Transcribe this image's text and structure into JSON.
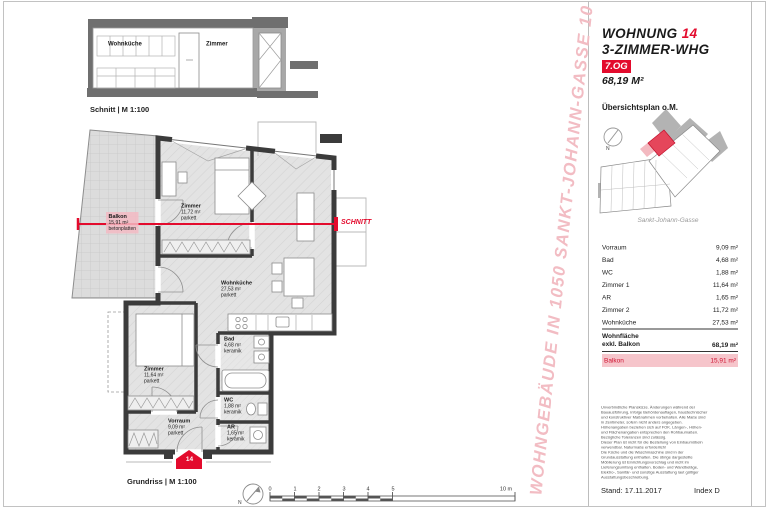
{
  "header": {
    "title": "WOHNUNG",
    "unit": "14",
    "type": "3-ZIMMER-WHG",
    "floor": "7.OG",
    "area": "68,19 M²"
  },
  "overview": {
    "title": "Übersichtsplan o.M.",
    "street": "Sankt-Johann-Gasse",
    "north": "N"
  },
  "section": {
    "caption": "Schnitt | M 1:100",
    "room1": "Wohnküche",
    "room2": "Zimmer"
  },
  "plan": {
    "caption": "Grundriss | M 1:100",
    "cut_label": "SCHNITT",
    "entrance": "14",
    "north": "N",
    "scale": {
      "t0": "0",
      "t1": "1",
      "t2": "2",
      "t3": "3",
      "t4": "4",
      "t5": "5",
      "end": "10 m"
    },
    "rooms": {
      "balkon": {
        "name": "Balkon",
        "area": "15,91 m²",
        "floor": "betonplatten"
      },
      "zimmer2": {
        "name": "Zimmer",
        "area": "11,72 m²",
        "floor": "parkett"
      },
      "wohnkueche": {
        "name": "Wohnküche",
        "area": "27,53 m²",
        "floor": "parkett"
      },
      "zimmer1": {
        "name": "Zimmer",
        "area": "11,64 m²",
        "floor": "parkett"
      },
      "bad": {
        "name": "Bad",
        "area": "4,68 m²",
        "floor": "keramik"
      },
      "wc": {
        "name": "WC",
        "area": "1,88 m²",
        "floor": "keramik"
      },
      "vorraum": {
        "name": "Vorraum",
        "area": "9,09 m²",
        "floor": "parkett"
      },
      "ar": {
        "name": "AR",
        "area": "1,65 m²",
        "floor": "keramik"
      }
    }
  },
  "table": {
    "rows": [
      {
        "label": "Vorraum",
        "value": "9,09 m²"
      },
      {
        "label": "Bad",
        "value": "4,68 m²"
      },
      {
        "label": "WC",
        "value": "1,88 m²"
      },
      {
        "label": "Zimmer 1",
        "value": "11,64 m²"
      },
      {
        "label": "AR",
        "value": "1,65 m²"
      },
      {
        "label": "Zimmer 2",
        "value": "11,72 m²"
      },
      {
        "label": "Wohnküche",
        "value": "27,53 m²"
      }
    ],
    "total_label_1": "Wohnfläche",
    "total_label_2": "exkl. Balkon",
    "total_value": "68,19 m²",
    "balkon_label": "Balkon",
    "balkon_value": "15,91 m²"
  },
  "watermark": "WOHNGEBÄUDE IN 1050 SANKT-JOHANN-GASSE 10",
  "footer": {
    "disclaimer": "Unverbindliche Planskizze. Änderungen während der\nBauausführung, infolge Behördenauflagen, haustechnischer\nund konstruktiver Maßnahmen vorbehalten. Alle Maße sind\nin Zentimeter, sofern nicht anders angegeben.\nHöhenangaben beziehen sich auf FOK. Längen-, Höhen-\nund Flächenangaben entsprechen den Rohbaumaßen.\nBezügliche Toleranzen sind zulässig.\nDieser Plan ist nicht für die Bestellung von Einbaumöbeln\nverwendbar. Naturmaße erforderlich!\nDie Küche und die Waschmaschine sind in der\nGrundausstattung enthalten. Die übrige dargestellte\nMöblierung ist Einrichtungsvorschlag und nicht im\nLieferungsumfang enthalten. Boden- und Wandbeläge,\nElektro-, Sanitär- und sonstige Ausstattung laut gültiger\nAusstattungsbeschreibung.",
    "stand": "Stand: 17.11.2017",
    "index": "Index D"
  },
  "colors": {
    "accent": "#e30b2d",
    "highlight_pink": "#f6c5cb",
    "watermark_pink": "#f2bcc3",
    "wall": "#3b3b3b",
    "slab_gray": "#6f6f6f",
    "neighbor_gray": "#b3b3b3"
  }
}
